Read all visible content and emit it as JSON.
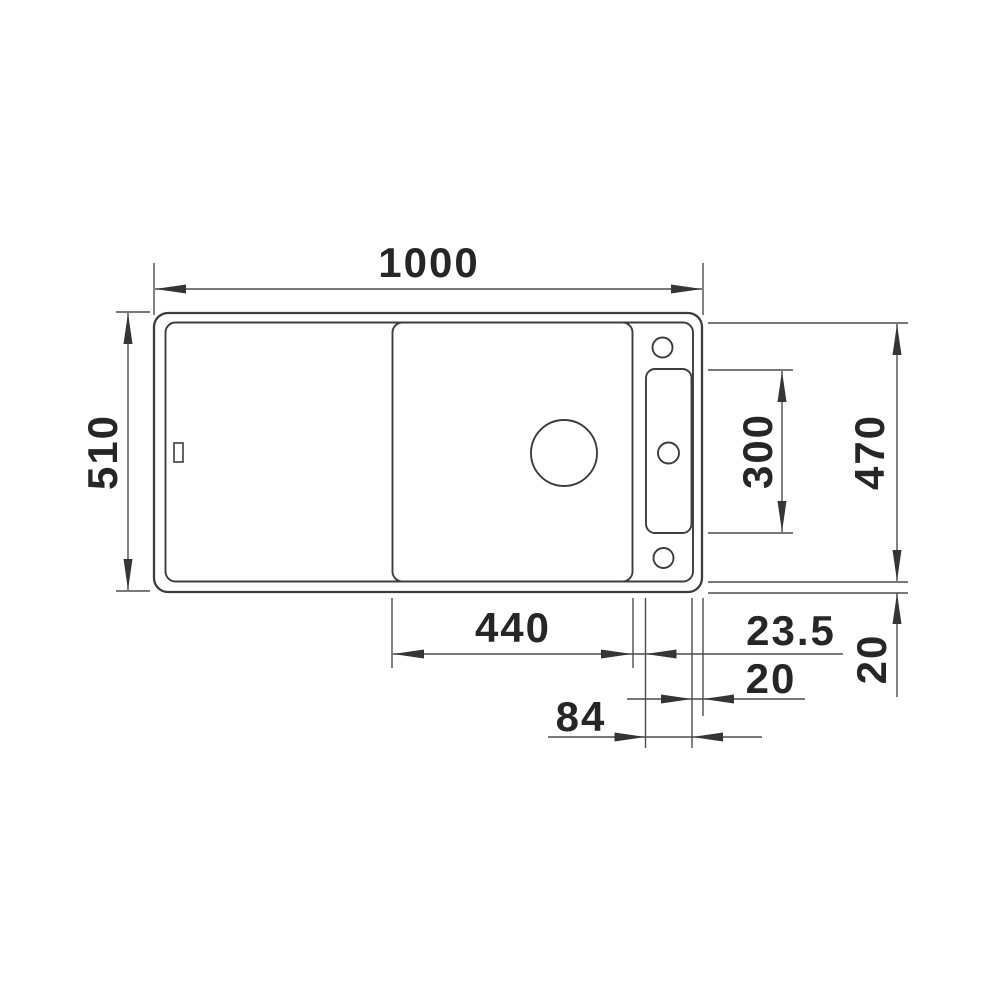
{
  "page": {
    "background": "#ffffff"
  },
  "drawing": {
    "subject": "kitchen sink top view dimension drawing",
    "view": "top",
    "line_color": "#3d3d3d",
    "dim_line_color": "#4c4c4c",
    "text_color": "#262626",
    "labels": {
      "overall_width": "1000",
      "overall_depth": "510",
      "right_inner_length": "470",
      "slot_length": "300",
      "middle_section_width": "440",
      "divider_to_slot": "23.5",
      "right_rim": "20",
      "bottom_rim": "20",
      "slot_width": "84"
    },
    "dimensions": [
      {
        "value": "1000",
        "orientation": "horizontal",
        "measures": "overall width, top"
      },
      {
        "value": "510",
        "orientation": "vertical",
        "measures": "overall depth, left"
      },
      {
        "value": "470",
        "orientation": "vertical",
        "measures": "inner bowl depth, right"
      },
      {
        "value": "300",
        "orientation": "vertical",
        "measures": "accessory slot length"
      },
      {
        "value": "440",
        "orientation": "horizontal",
        "measures": "middle section width, bottom"
      },
      {
        "value": "23.5",
        "orientation": "horizontal",
        "measures": "divider to slot offset"
      },
      {
        "value": "20",
        "orientation": "horizontal",
        "measures": "right rim width"
      },
      {
        "value": "20",
        "orientation": "vertical",
        "measures": "bottom rim width"
      },
      {
        "value": "84",
        "orientation": "horizontal",
        "measures": "accessory slot width"
      }
    ]
  }
}
